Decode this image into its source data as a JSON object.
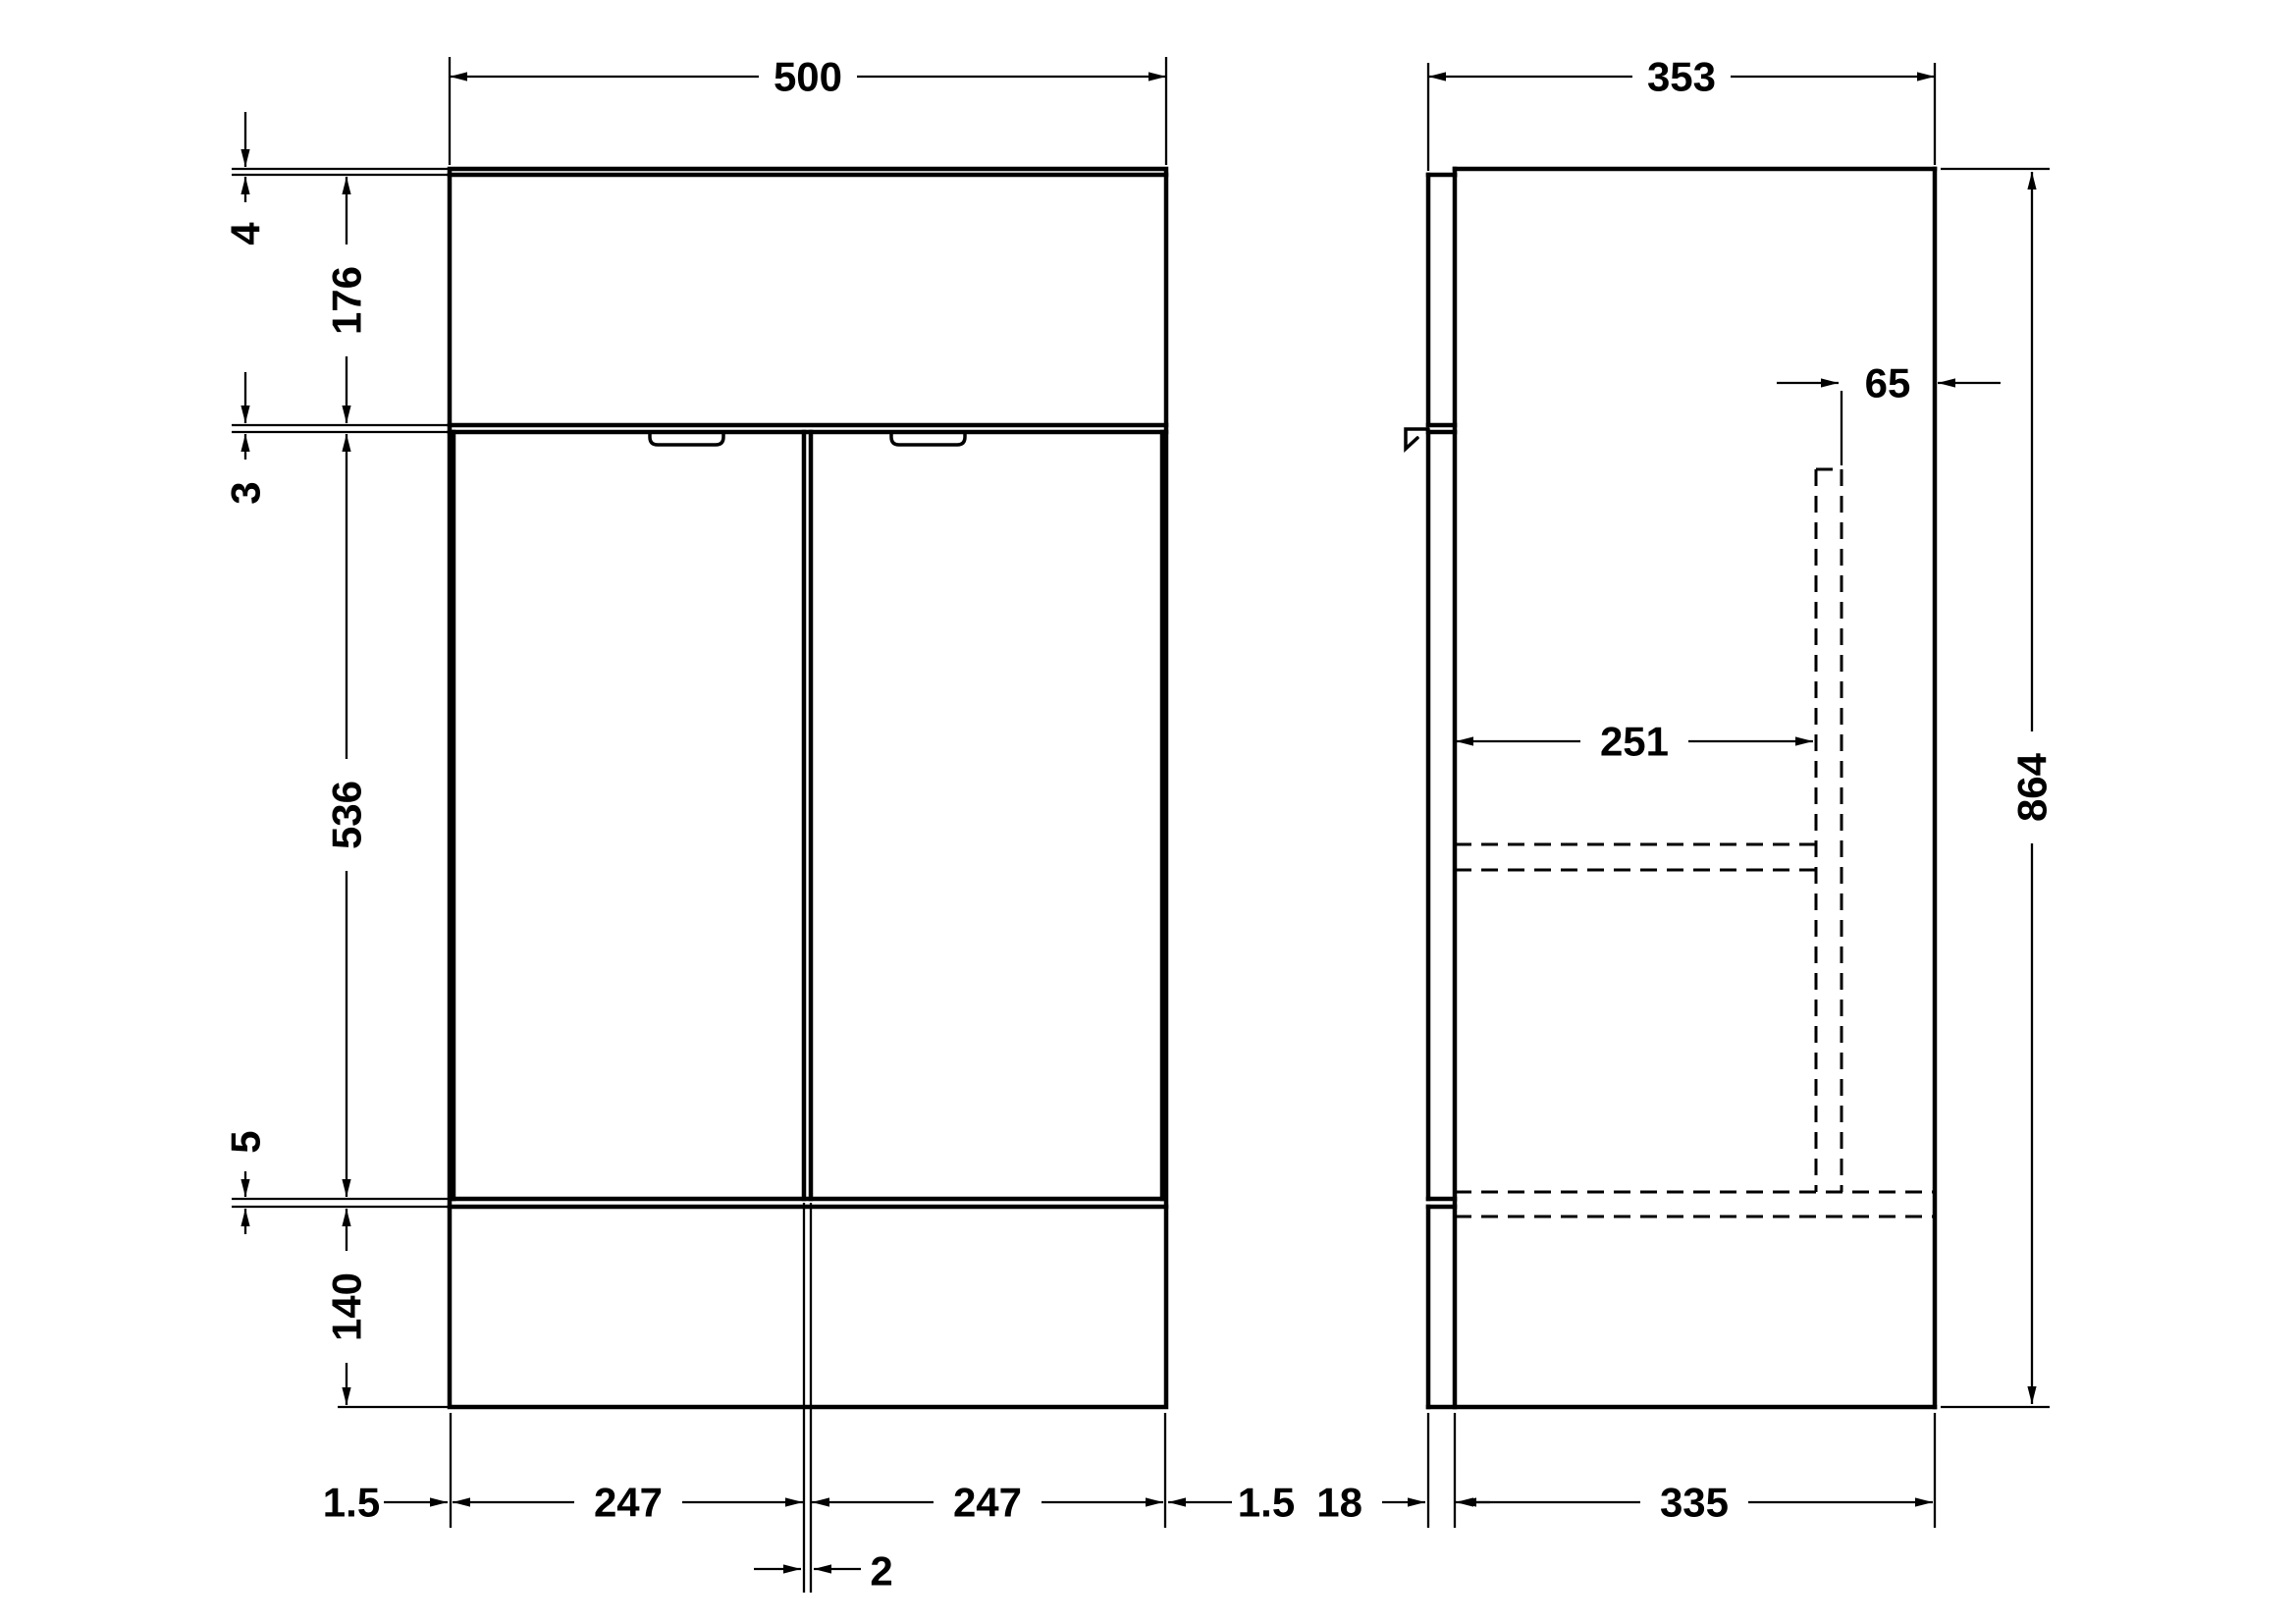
{
  "drawing": {
    "background_color": "#ffffff",
    "line_color": "#000000",
    "front_view": {
      "width": "500",
      "top_lip": "4",
      "basin_panel_height": "176",
      "top_reveal": "3",
      "door_height": "536",
      "bottom_reveal": "5",
      "plinth_height": "140",
      "left_edge_gap": "1.5",
      "left_door_width": "247",
      "right_door_width": "247",
      "right_edge_gap": "1.5",
      "center_door_gap": "2"
    },
    "side_view": {
      "overall_depth": "353",
      "rear_service_gap": "65",
      "internal_depth": "251",
      "overall_height": "864",
      "front_plane_offset": "18",
      "carcass_depth": "335"
    }
  }
}
